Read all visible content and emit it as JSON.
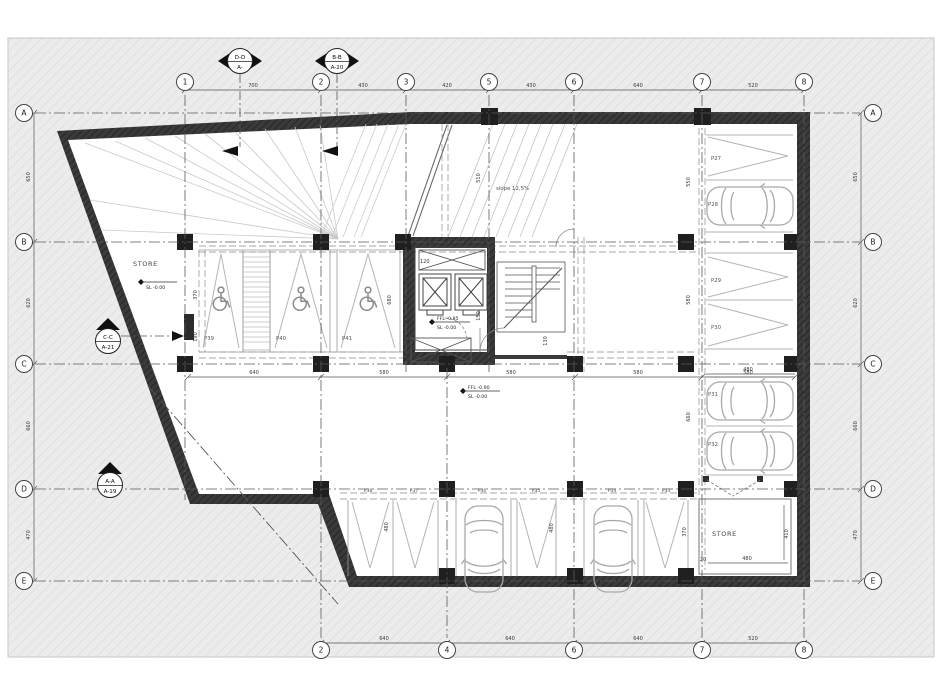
{
  "sheet": {
    "background": "#ededed",
    "paper": "#ffffff",
    "wall_color": "#343434",
    "accent_line": "#4a4a4a"
  },
  "grid": {
    "top": [
      "1",
      "2",
      "3",
      "5",
      "6",
      "7",
      "8"
    ],
    "bottom": [
      "2",
      "4",
      "6",
      "7",
      "8"
    ],
    "left": [
      "A",
      "B",
      "C",
      "D",
      "E"
    ],
    "right": [
      "A",
      "B",
      "C",
      "D",
      "E"
    ]
  },
  "dims": {
    "top": [
      "700",
      "430",
      "420",
      "430",
      "640",
      "520"
    ],
    "bottom": [
      "640",
      "640",
      "640",
      "520"
    ],
    "left": [
      "650",
      "620",
      "660",
      "470"
    ],
    "right": [
      "650",
      "620",
      "660",
      "470"
    ],
    "aisle": [
      "640",
      "580",
      "580",
      "580",
      "580"
    ],
    "misc": {
      "hand_370": "370",
      "hand_190": "190",
      "hand_680": "680",
      "ramp_510": "510",
      "right_480": "480",
      "right_550": "550",
      "right_580": "580",
      "right_660": "660",
      "right_370": "370",
      "bot_480a": "480",
      "bot_480b": "480",
      "store_480": "480",
      "store_410": "410",
      "store_20": "20",
      "core_120": "120",
      "core_150": "150",
      "core_130": "130"
    }
  },
  "sections": {
    "dd_top": "D-D",
    "dd_bot": "A-",
    "bb_top": "B-B",
    "bb_bot": "A-20",
    "cc_top": "C-C",
    "cc_bot": "A-21",
    "aa_top": "A-A",
    "aa_bot": "A-19"
  },
  "rooms": {
    "store_left": "STORE",
    "store_right": "STORE"
  },
  "levels": {
    "store_sl": "SL -0.00",
    "core_ffl": "FFL -0.85",
    "core_sl": "SL -0.00",
    "aisle_ffl": "FFL -0.90",
    "aisle_sl": "SL -0.00"
  },
  "ramp": {
    "slope_label": "slope 12,5%"
  },
  "parking": {
    "right": [
      "P27",
      "P28",
      "P29",
      "P30",
      "P31",
      "P32"
    ],
    "handicap": [
      "P39",
      "P40",
      "P41"
    ],
    "bottom": [
      "P38",
      "P37",
      "P36",
      "P35",
      "P34",
      "P33"
    ]
  }
}
